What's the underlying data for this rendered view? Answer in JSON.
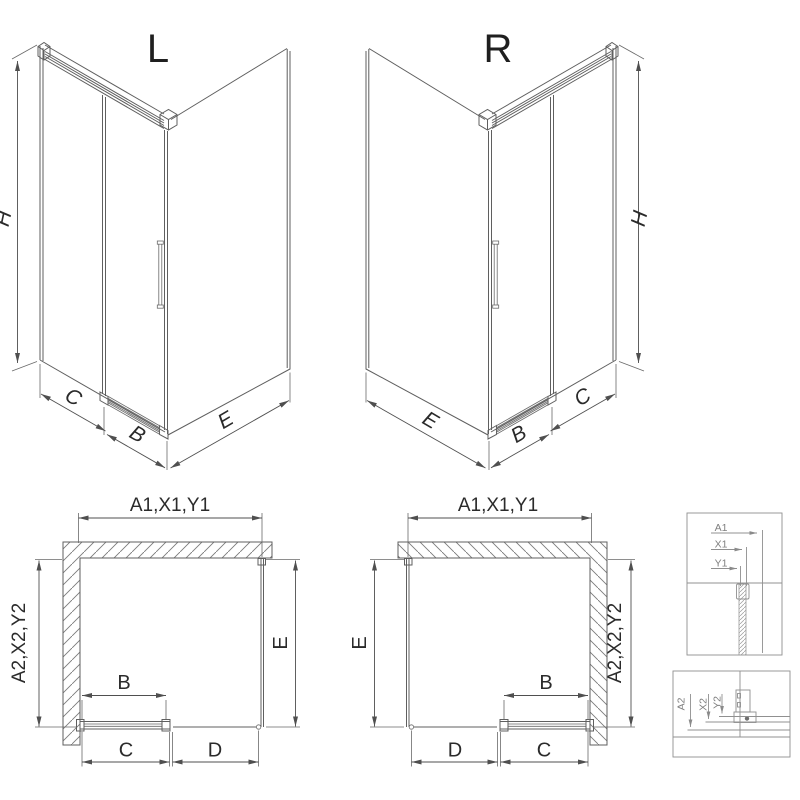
{
  "figure": {
    "background": "#ffffff",
    "line_color": "#5f5f5f",
    "text_color": "#1f1f1f",
    "detail_color": "#909090"
  },
  "iso_left": {
    "variant_label": "L",
    "height_dim": "H",
    "side_panel_dim": "C",
    "door_dim": "B",
    "return_panel_dim": "E"
  },
  "iso_right": {
    "variant_label": "R",
    "height_dim": "H",
    "side_panel_dim": "C",
    "door_dim": "B",
    "return_panel_dim": "E"
  },
  "plan_left": {
    "width_dim": "A1,X1,Y1",
    "wall_depth_dim": "A2,X2,Y2",
    "glass_depth_dim": "E",
    "door_dim": "B",
    "bottom_dims": [
      "C",
      "D"
    ]
  },
  "plan_right": {
    "width_dim": "A1,X1,Y1",
    "wall_depth_dim": "A2,X2,Y2",
    "glass_depth_dim": "E",
    "door_dim": "B",
    "bottom_dims": [
      "D",
      "C"
    ]
  },
  "detail_top": {
    "dims": [
      "A1",
      "X1",
      "Y1"
    ]
  },
  "detail_bottom": {
    "dims": [
      "A2",
      "X2",
      "Y2"
    ]
  }
}
